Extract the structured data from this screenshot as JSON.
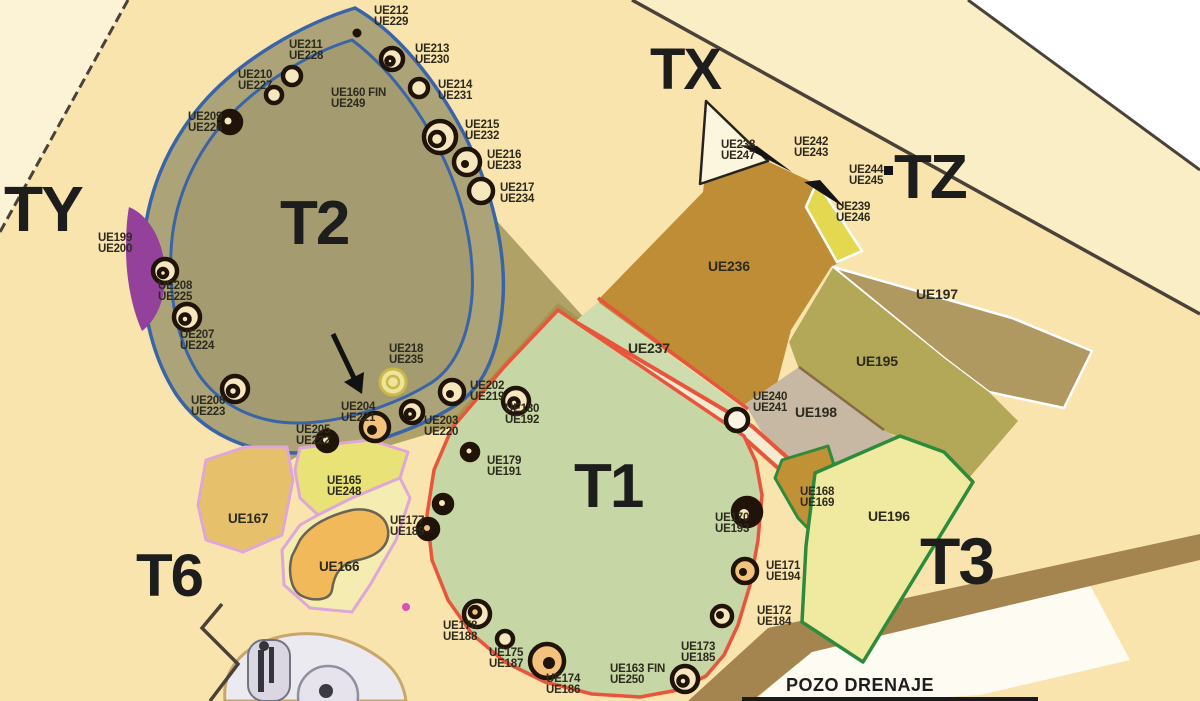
{
  "map_title": "Excavation sectors plan",
  "colors": {
    "bg_main": "#FAE4AE",
    "bg_outer": "#FCF2D6",
    "bg_band": "#F9EEC6",
    "white": "#FFFFFF",
    "boundary_dark": "#4A4238",
    "t2_olive": "#ACA478",
    "t2_inner": "#A49C70",
    "t2_blue": "#3A64A8",
    "khaki": "#B0A167",
    "mustard": "#A3944E",
    "purple": "#93419B",
    "t1_green": "#C6D6A4",
    "t1_red": "#E8553C",
    "road_cream": "#F5EBD0",
    "strip_green": "#CFDCAE",
    "ue236_brown": "#BE8D35",
    "ue197_tan": "#B09961",
    "ue195_olive": "#B2A857",
    "ue198_gray": "#C6B8A2",
    "ue196_yellow": "#F0EAA0",
    "ue168_ochre": "#C19136",
    "green_line": "#2E8B3C",
    "patch_gold": "#E7C06B",
    "patch_lime": "#E9E377",
    "patch_pale": "#F4ECB0",
    "patch_orange": "#F2B95B",
    "pink_line": "#DDA8D8",
    "brown_stripe": "#A5854F",
    "pozo_white": "#FDFBF2",
    "feature_dark": "#201307",
    "feature_cream": "#F7E7BF",
    "feature_orange": "#F3C27D",
    "label_dark": "#2D2A1E"
  },
  "zone_labels": [
    {
      "text": "TX",
      "x": 650,
      "y": 45,
      "size": 58
    },
    {
      "text": "TY",
      "x": 4,
      "y": 182,
      "size": 64
    },
    {
      "text": "TZ",
      "x": 894,
      "y": 152,
      "size": 62
    },
    {
      "text": "T2",
      "x": 280,
      "y": 198,
      "size": 62
    },
    {
      "text": "T1",
      "x": 574,
      "y": 461,
      "size": 62
    },
    {
      "text": "T3",
      "x": 920,
      "y": 533,
      "size": 66
    },
    {
      "text": "T6",
      "x": 136,
      "y": 550,
      "size": 60
    },
    {
      "text": "POZO DRENAJE",
      "x": 786,
      "y": 678,
      "size": 18,
      "small": true
    }
  ],
  "ue_labels": [
    {
      "lines": [
        "UE212",
        "UE229"
      ],
      "x": 374,
      "y": 6
    },
    {
      "lines": [
        "UE211",
        "UE228"
      ],
      "x": 289,
      "y": 40
    },
    {
      "lines": [
        "UE213",
        "UE230"
      ],
      "x": 415,
      "y": 44
    },
    {
      "lines": [
        "UE210",
        "UE227"
      ],
      "x": 238,
      "y": 70
    },
    {
      "lines": [
        "UE214",
        "UE231"
      ],
      "x": 438,
      "y": 80
    },
    {
      "lines": [
        "UE160 FIN",
        "UE249"
      ],
      "x": 331,
      "y": 88
    },
    {
      "lines": [
        "UE209",
        "UE226"
      ],
      "x": 188,
      "y": 112
    },
    {
      "lines": [
        "UE215",
        "UE232"
      ],
      "x": 465,
      "y": 120
    },
    {
      "lines": [
        "UE216",
        "UE233"
      ],
      "x": 487,
      "y": 150
    },
    {
      "lines": [
        "UE217",
        "UE234"
      ],
      "x": 500,
      "y": 183
    },
    {
      "lines": [
        "UE199",
        "UE200"
      ],
      "x": 98,
      "y": 233
    },
    {
      "lines": [
        "UE208",
        "UE225"
      ],
      "x": 158,
      "y": 281
    },
    {
      "lines": [
        "UE207",
        "UE224"
      ],
      "x": 180,
      "y": 330
    },
    {
      "lines": [
        "UE206",
        "UE223"
      ],
      "x": 191,
      "y": 396
    },
    {
      "lines": [
        "UE205",
        "UE222"
      ],
      "x": 296,
      "y": 425
    },
    {
      "lines": [
        "UE204",
        "UE221"
      ],
      "x": 341,
      "y": 402
    },
    {
      "lines": [
        "UE218",
        "UE235"
      ],
      "x": 389,
      "y": 344
    },
    {
      "lines": [
        "UE202",
        "UE219"
      ],
      "x": 470,
      "y": 381
    },
    {
      "lines": [
        "UE180",
        "UE192"
      ],
      "x": 505,
      "y": 404
    },
    {
      "lines": [
        "UE203",
        "UE220"
      ],
      "x": 424,
      "y": 416
    },
    {
      "lines": [
        "UE179",
        "UE191"
      ],
      "x": 487,
      "y": 456
    },
    {
      "lines": [
        "UE177",
        "UE189"
      ],
      "x": 390,
      "y": 516
    },
    {
      "lines": [
        "UE165",
        "UE248"
      ],
      "x": 327,
      "y": 476
    },
    {
      "lines": [
        "UE167"
      ],
      "x": 228,
      "y": 512,
      "size": 13.5
    },
    {
      "lines": [
        "UE166"
      ],
      "x": 319,
      "y": 560,
      "size": 13.5
    },
    {
      "lines": [
        "UE178",
        "UE188"
      ],
      "x": 443,
      "y": 621
    },
    {
      "lines": [
        "UE175",
        "UE187"
      ],
      "x": 489,
      "y": 648
    },
    {
      "lines": [
        "UE174",
        "UE186"
      ],
      "x": 546,
      "y": 674
    },
    {
      "lines": [
        "UE163 FIN",
        "UE250"
      ],
      "x": 610,
      "y": 664
    },
    {
      "lines": [
        "UE173",
        "UE185"
      ],
      "x": 681,
      "y": 642
    },
    {
      "lines": [
        "UE172",
        "UE184"
      ],
      "x": 757,
      "y": 606
    },
    {
      "lines": [
        "UE171",
        "UE194"
      ],
      "x": 766,
      "y": 561
    },
    {
      "lines": [
        "UE170",
        "UE193"
      ],
      "x": 715,
      "y": 513
    },
    {
      "lines": [
        "UE236"
      ],
      "x": 708,
      "y": 260,
      "size": 14
    },
    {
      "lines": [
        "UE237"
      ],
      "x": 628,
      "y": 342,
      "size": 14
    },
    {
      "lines": [
        "UE238",
        "UE247"
      ],
      "x": 721,
      "y": 140
    },
    {
      "lines": [
        "UE242",
        "UE243"
      ],
      "x": 794,
      "y": 137
    },
    {
      "lines": [
        "UE244",
        "UE245"
      ],
      "x": 849,
      "y": 165
    },
    {
      "lines": [
        "UE239",
        "UE246"
      ],
      "x": 836,
      "y": 202
    },
    {
      "lines": [
        "UE197"
      ],
      "x": 916,
      "y": 288,
      "size": 14
    },
    {
      "lines": [
        "UE195"
      ],
      "x": 856,
      "y": 355,
      "size": 14
    },
    {
      "lines": [
        "UE240",
        "UE241"
      ],
      "x": 753,
      "y": 392
    },
    {
      "lines": [
        "UE198"
      ],
      "x": 795,
      "y": 406,
      "size": 14
    },
    {
      "lines": [
        "UE168",
        "UE169"
      ],
      "x": 800,
      "y": 487
    },
    {
      "lines": [
        "UE196"
      ],
      "x": 868,
      "y": 510,
      "size": 14
    }
  ]
}
